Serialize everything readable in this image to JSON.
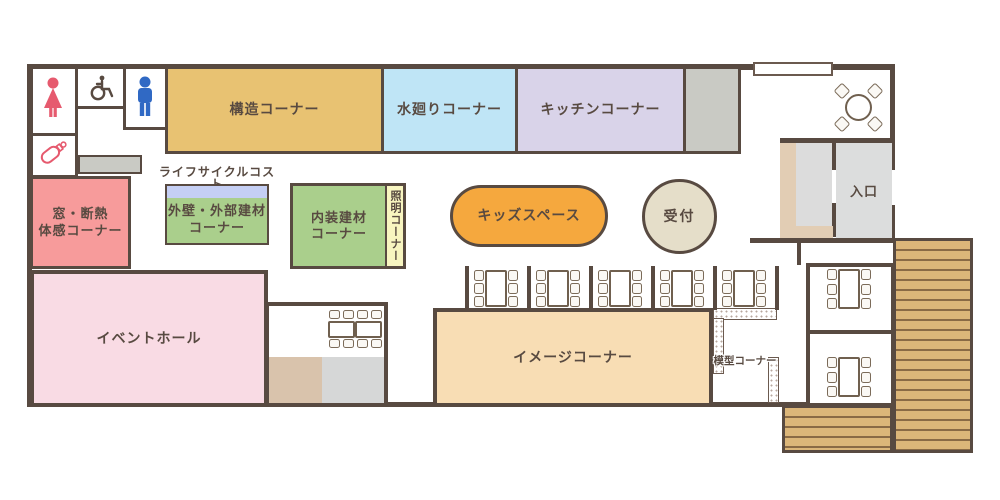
{
  "plan": {
    "rooms": {
      "structure": {
        "label": "構造コーナー",
        "color": "#e8c272"
      },
      "water": {
        "label": "水廻りコーナー",
        "color": "#bfe5f6"
      },
      "kitchen": {
        "label": "キッチンコーナー",
        "color": "#d9d3e9"
      },
      "window_insulation": {
        "label_line1": "窓・断熱",
        "label_line2": "体感コーナー",
        "color": "#f79b9b"
      },
      "lifecycle": {
        "label_line1": "ライフサイクルコスト",
        "label_line2": "ブース",
        "header_color": "#c5cff4"
      },
      "exterior": {
        "label_line1": "外壁・外部建材",
        "label_line2": "コーナー",
        "color": "#aacf8c"
      },
      "interior": {
        "label_line1": "内装建材",
        "label_line2": "コーナー",
        "color": "#aacf8c"
      },
      "lighting": {
        "label": "照明コーナー",
        "color": "#f8f5c0"
      },
      "kids": {
        "label": "キッズスペース",
        "color": "#f5a83e"
      },
      "reception": {
        "label": "受付",
        "color": "#e5dec9"
      },
      "entrance": {
        "label": "入口",
        "color": "#dcdddd"
      },
      "event_hall": {
        "label": "イベントホール",
        "color": "#f9dbe4"
      },
      "image": {
        "label": "イメージコーナー",
        "color": "#f8ddb4"
      },
      "model": {
        "label": "模型コーナー"
      }
    },
    "icons": {
      "woman": "woman-icon",
      "wheelchair": "wheelchair-icon",
      "man": "man-icon",
      "baby_bottle": "baby-bottle-icon"
    },
    "furniture": {
      "booth_tables": {
        "count": 5,
        "seats_per_table": 6
      },
      "meeting_rooms": {
        "count": 2,
        "seats_per_table": 6
      },
      "hall_annex_table_seats": 8,
      "round_table_seats": 4
    },
    "colors": {
      "wall": "#584a41",
      "gray_block": "#c9cac4",
      "annex_tan": "#d9c3ac",
      "annex_gray": "#d6d7d7",
      "entrance_beige": "#e2cdb4",
      "entrance_gray": "#dcdcdc",
      "deck_fill": "#dcb679",
      "deck_line": "#8a6a45",
      "icon_red": "#e65a6e",
      "icon_blue": "#3069c4"
    }
  }
}
